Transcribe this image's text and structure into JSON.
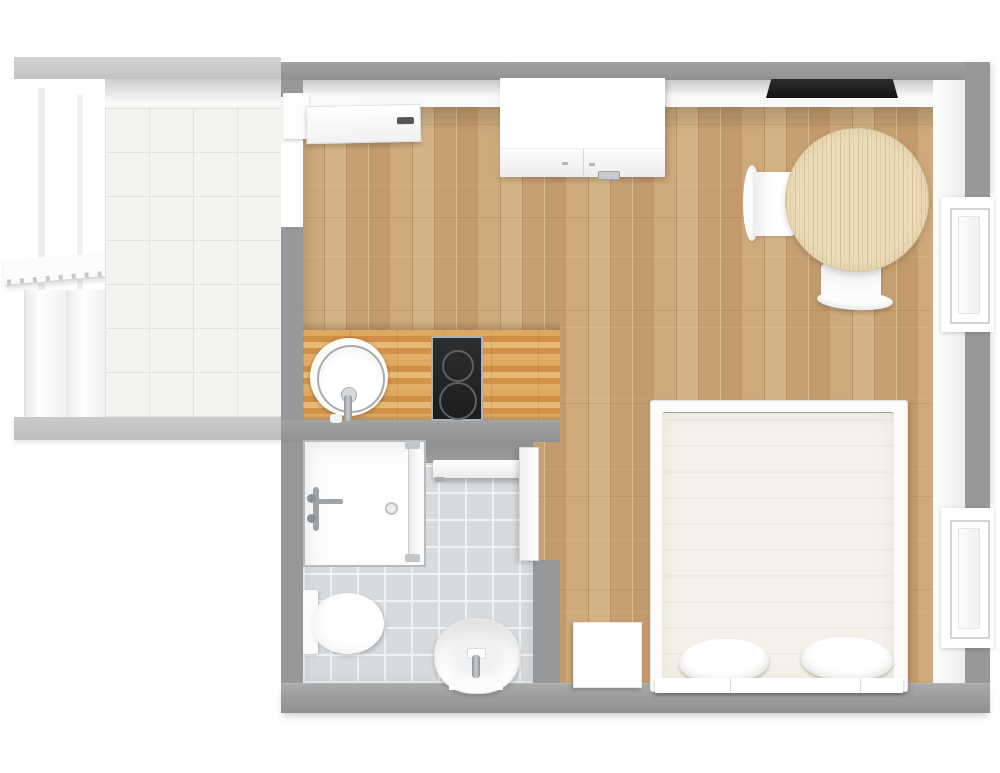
{
  "scene": {
    "kind": "floor-plan",
    "view": "top-down 3D render of a studio apartment",
    "rooms": [
      {
        "name": "stair-landing",
        "floor": "white ceramic tile",
        "features": [
          "staircase",
          "railing"
        ]
      },
      {
        "name": "main-room",
        "floor": "light oak plank parquet"
      },
      {
        "name": "kitchenette",
        "floor": "butcher-block counter along left wall"
      },
      {
        "name": "bathroom",
        "floor": "grey ceramic tile"
      }
    ],
    "furniture": [
      "entrance-door",
      "wardrobe",
      "wall-tv",
      "round-dining-table",
      "dining-chair-west",
      "dining-chair-south",
      "double-bed",
      "pillow-left",
      "pillow-right",
      "nightstand",
      "kitchen-round-sink",
      "two-burner-cooktop",
      "shower-cabin",
      "towel-rail",
      "bathroom-door",
      "toilet",
      "washbasin",
      "window-upper-right",
      "window-lower-right",
      "stair-railing"
    ]
  },
  "palette": {
    "background": "#ffffff",
    "interior_wall": "#96989a",
    "landing_wall": "#c7c8c8",
    "wood_floor": "#c7a072",
    "counter_wood": "#dba55e",
    "table_wood": "#ecdcb8",
    "bath_tile": "#d7dbde",
    "entry_tile": "#f3f4f0",
    "mattress": "#f3f1e8",
    "tv_black": "#1a1b1d",
    "cooktop_black": "#232527",
    "chrome": "#9fa3a6",
    "fixture_white": "#fdfdfd"
  }
}
